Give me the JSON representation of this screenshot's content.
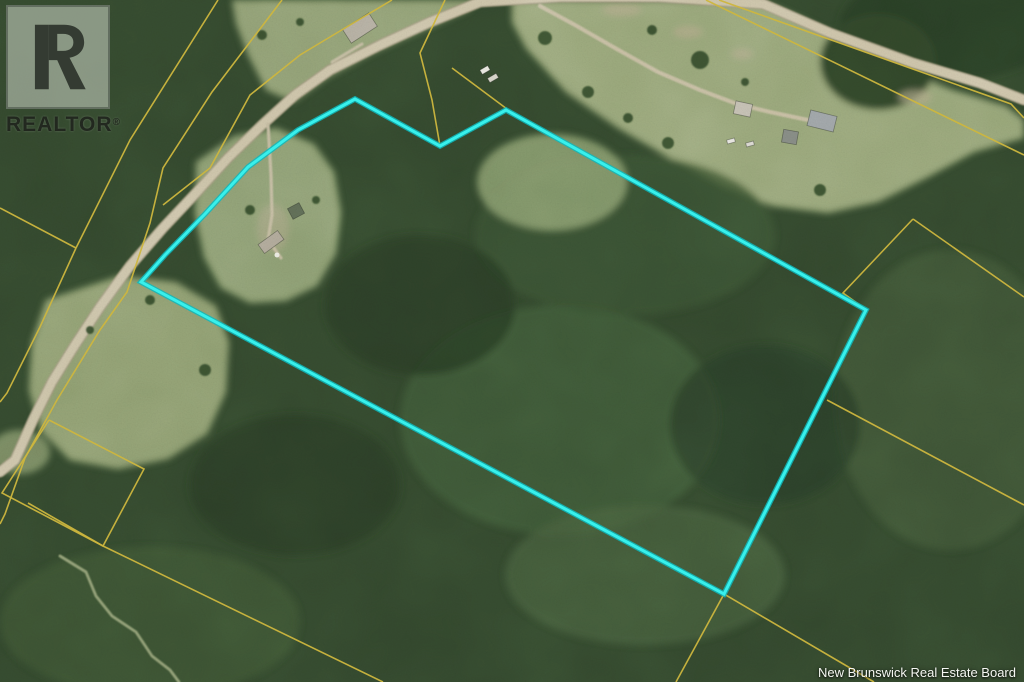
{
  "watermark": {
    "logo_text": "REALTOR",
    "registered_mark": "®"
  },
  "attribution": {
    "text": "New Brunswick Real Estate Board"
  },
  "map": {
    "canvas": {
      "width": 1024,
      "height": 682
    },
    "colors": {
      "boundary_cyan": "#38f0ec",
      "boundary_cyan_glow": "#0fb8bc",
      "parcel_yellow": "#cdb63e",
      "road_fill": "#d2c9ae",
      "road_edge": "#a89f84",
      "forest_base": "#34492e",
      "pasture": "#9aa87a"
    },
    "property_boundary": {
      "points": [
        [
          141,
          282
        ],
        [
          165,
          255
        ],
        [
          205,
          214
        ],
        [
          248,
          167
        ],
        [
          298,
          130
        ],
        [
          355,
          99
        ],
        [
          440,
          146
        ],
        [
          506,
          110
        ],
        [
          866,
          310
        ],
        [
          724,
          594
        ]
      ]
    },
    "parcel_lines": [
      {
        "name": "parcel-line-nw-diagonal-1",
        "points": [
          [
            218,
            0
          ],
          [
            130,
            140
          ],
          [
            76,
            248
          ]
        ]
      },
      {
        "name": "parcel-line-west-branch",
        "points": [
          [
            76,
            248
          ],
          [
            0,
            208
          ]
        ]
      },
      {
        "name": "parcel-line-road-west",
        "points": [
          [
            76,
            248
          ],
          [
            40,
            327
          ],
          [
            7,
            393
          ],
          [
            0,
            402
          ]
        ]
      },
      {
        "name": "parcel-line-nw-diagonal-2",
        "points": [
          [
            282,
            0
          ],
          [
            212,
            92
          ],
          [
            163,
            168
          ],
          [
            150,
            223
          ],
          [
            127,
            292
          ],
          [
            100,
            330
          ],
          [
            57,
            400
          ],
          [
            25,
            458
          ],
          [
            5,
            514
          ],
          [
            0,
            524
          ]
        ]
      },
      {
        "name": "parcel-line-road-east",
        "points": [
          [
            392,
            0
          ],
          [
            350,
            25
          ],
          [
            300,
            55
          ],
          [
            250,
            95
          ],
          [
            210,
            168
          ],
          [
            163,
            205
          ]
        ]
      },
      {
        "name": "parcel-line-lot-cross-road",
        "points": [
          [
            445,
            0
          ],
          [
            420,
            53
          ],
          [
            432,
            100
          ],
          [
            440,
            146
          ]
        ]
      },
      {
        "name": "parcel-line-lot-to-peak",
        "points": [
          [
            452,
            68
          ],
          [
            507,
            109
          ]
        ]
      },
      {
        "name": "parcel-line-field-parcel",
        "points": [
          [
            49,
            420
          ],
          [
            144,
            469
          ],
          [
            103,
            546
          ],
          [
            2,
            493
          ],
          [
            49,
            420
          ]
        ]
      },
      {
        "name": "parcel-line-long-south-diagonal",
        "points": [
          [
            28,
            503
          ],
          [
            103,
            546
          ],
          [
            383,
            682
          ]
        ]
      },
      {
        "name": "parcel-line-ne-road-north",
        "points": [
          [
            719,
            0
          ],
          [
            1011,
            104
          ],
          [
            1024,
            118
          ]
        ]
      },
      {
        "name": "parcel-line-ne-road-south",
        "points": [
          [
            706,
            0
          ],
          [
            1024,
            155
          ]
        ]
      },
      {
        "name": "parcel-line-ne-chevron-west",
        "points": [
          [
            913,
            219
          ],
          [
            843,
            293
          ],
          [
            864,
            308
          ]
        ]
      },
      {
        "name": "parcel-line-ne-chevron-east",
        "points": [
          [
            913,
            219
          ],
          [
            1024,
            297
          ]
        ]
      },
      {
        "name": "parcel-line-se-from-boundary",
        "points": [
          [
            827,
            400
          ],
          [
            1024,
            505
          ]
        ]
      },
      {
        "name": "parcel-line-south-corner-east",
        "points": [
          [
            724,
            594
          ],
          [
            874,
            682
          ]
        ]
      },
      {
        "name": "parcel-line-south-corner-south",
        "points": [
          [
            724,
            594
          ],
          [
            676,
            682
          ]
        ]
      }
    ],
    "roads": [
      {
        "name": "main-road",
        "width": 8.5,
        "color": "#cfc6ab",
        "casing": "#a39a7f",
        "points": [
          [
            1024,
            100
          ],
          [
            980,
            83
          ],
          [
            913,
            63
          ],
          [
            830,
            33
          ],
          [
            763,
            4
          ],
          [
            660,
            -3
          ],
          [
            560,
            -3
          ],
          [
            480,
            2
          ],
          [
            430,
            22
          ],
          [
            380,
            45
          ],
          [
            330,
            70
          ],
          [
            295,
            95
          ],
          [
            262,
            125
          ],
          [
            228,
            158
          ],
          [
            196,
            193
          ],
          [
            163,
            228
          ],
          [
            130,
            266
          ],
          [
            100,
            307
          ],
          [
            75,
            345
          ],
          [
            52,
            382
          ],
          [
            33,
            420
          ],
          [
            15,
            460
          ],
          [
            0,
            472
          ]
        ]
      },
      {
        "name": "driveway-northeast",
        "width": 4,
        "color": "#c9c0a4",
        "casing": null,
        "points": [
          [
            540,
            6
          ],
          [
            575,
            25
          ],
          [
            615,
            48
          ],
          [
            658,
            72
          ],
          [
            700,
            90
          ],
          [
            737,
            104
          ],
          [
            770,
            112
          ],
          [
            808,
            120
          ]
        ]
      },
      {
        "name": "driveway-property",
        "width": 3.2,
        "color": "#c6bda2",
        "casing": null,
        "points": [
          [
            268,
            124
          ],
          [
            271,
            175
          ],
          [
            272,
            215
          ],
          [
            268,
            240
          ],
          [
            281,
            258
          ]
        ]
      },
      {
        "name": "driveway-house-topleft",
        "width": 3,
        "color": "#c6bda2",
        "casing": null,
        "points": [
          [
            332,
            62
          ],
          [
            352,
            50
          ],
          [
            362,
            44
          ]
        ]
      },
      {
        "name": "trail-southwest",
        "width": 2.8,
        "color": "#93a077",
        "casing": null,
        "points": [
          [
            60,
            556
          ],
          [
            86,
            572
          ],
          [
            96,
            596
          ],
          [
            112,
            616
          ],
          [
            136,
            632
          ],
          [
            152,
            656
          ],
          [
            170,
            670
          ],
          [
            179,
            682
          ]
        ]
      }
    ],
    "buildings": [
      {
        "name": "house-top-left",
        "cx": 360,
        "cy": 28,
        "w": 31,
        "h": 16,
        "rot": -33,
        "fill": "#b6b0a2"
      },
      {
        "name": "vehicle-top-1",
        "cx": 485,
        "cy": 70,
        "w": 9,
        "h": 5,
        "rot": -30,
        "fill": "#ecebe3"
      },
      {
        "name": "vehicle-top-2",
        "cx": 493,
        "cy": 78,
        "w": 10,
        "h": 5,
        "rot": -30,
        "fill": "#d9d6cb"
      },
      {
        "name": "house-north",
        "cx": 743,
        "cy": 109,
        "w": 17,
        "h": 13,
        "rot": 12,
        "fill": "#c6c1b4"
      },
      {
        "name": "barn-north",
        "cx": 822,
        "cy": 121,
        "w": 27,
        "h": 16,
        "rot": 14,
        "fill": "#9fa5a8"
      },
      {
        "name": "shed-north",
        "cx": 790,
        "cy": 137,
        "w": 15,
        "h": 13,
        "rot": 10,
        "fill": "#868b84"
      },
      {
        "name": "car-north-1",
        "cx": 731,
        "cy": 141,
        "w": 8,
        "h": 4,
        "rot": -15,
        "fill": "#e9e8e2"
      },
      {
        "name": "car-north-2",
        "cx": 750,
        "cy": 144,
        "w": 8,
        "h": 4,
        "rot": -15,
        "fill": "#dedcd4"
      },
      {
        "name": "house-in-parcel",
        "cx": 271,
        "cy": 242,
        "w": 24,
        "h": 11,
        "rot": -36,
        "fill": "#b2ab9b"
      },
      {
        "name": "shed-in-parcel",
        "cx": 296,
        "cy": 211,
        "w": 13,
        "h": 12,
        "rot": -28,
        "fill": "#5e6b55"
      }
    ],
    "markers": [
      {
        "name": "white-dot-in-parcel",
        "x": 277,
        "y": 255,
        "r": 2.5,
        "fill": "#efeee6"
      }
    ],
    "terrain": {
      "pastures": [
        {
          "name": "pasture-northeast",
          "fill": "#9aa87a",
          "points": [
            [
              512,
              0
            ],
            [
              760,
              0
            ],
            [
              800,
              18
            ],
            [
              852,
              44
            ],
            [
              902,
              70
            ],
            [
              952,
              90
            ],
            [
              1006,
              106
            ],
            [
              1024,
              120
            ],
            [
              1024,
              138
            ],
            [
              974,
              152
            ],
            [
              928,
              177
            ],
            [
              878,
              202
            ],
            [
              828,
              213
            ],
            [
              773,
              206
            ],
            [
              723,
              186
            ],
            [
              670,
              158
            ],
            [
              618,
              128
            ],
            [
              566,
              92
            ],
            [
              526,
              48
            ],
            [
              512,
              22
            ]
          ]
        },
        {
          "name": "pasture-top-center",
          "fill": "#93a276",
          "points": [
            [
              232,
              0
            ],
            [
              480,
              0
            ],
            [
              468,
              10
            ],
            [
              418,
              32
            ],
            [
              370,
              54
            ],
            [
              328,
              77
            ],
            [
              293,
              102
            ],
            [
              266,
              90
            ],
            [
              248,
              55
            ],
            [
              236,
              24
            ]
          ]
        },
        {
          "name": "clearing-in-parcel",
          "fill": "#90a175",
          "points": [
            [
              196,
              162
            ],
            [
              234,
              136
            ],
            [
              276,
              128
            ],
            [
              314,
              144
            ],
            [
              334,
              172
            ],
            [
              341,
              212
            ],
            [
              336,
              254
            ],
            [
              317,
              286
            ],
            [
              286,
              301
            ],
            [
              250,
              303
            ],
            [
              221,
              288
            ],
            [
              204,
              257
            ],
            [
              195,
              214
            ]
          ]
        },
        {
          "name": "field-west",
          "fill": "#92a173",
          "points": [
            [
              46,
              300
            ],
            [
              120,
              276
            ],
            [
              176,
              282
            ],
            [
              216,
              306
            ],
            [
              229,
              342
            ],
            [
              226,
              392
            ],
            [
              207,
              434
            ],
            [
              168,
              459
            ],
            [
              118,
              469
            ],
            [
              70,
              460
            ],
            [
              41,
              431
            ],
            [
              29,
              390
            ],
            [
              32,
              342
            ]
          ]
        }
      ],
      "forest_patches": [
        {
          "name": "forest-topright-corner",
          "cx": 950,
          "cy": 25,
          "rx": 110,
          "ry": 55,
          "fill": "#2c4128",
          "op": 1
        },
        {
          "name": "forest-ne-mid",
          "cx": 878,
          "cy": 62,
          "rx": 58,
          "ry": 48,
          "fill": "#30462b",
          "op": 1
        },
        {
          "name": "light-forest-right",
          "cx": 950,
          "cy": 400,
          "rx": 115,
          "ry": 150,
          "fill": "#415839",
          "op": 0.8
        },
        {
          "name": "light-forest-mid",
          "cx": 560,
          "cy": 420,
          "rx": 160,
          "ry": 115,
          "fill": "#45603b",
          "op": 0.7
        },
        {
          "name": "light-forest-lowmid",
          "cx": 645,
          "cy": 575,
          "rx": 140,
          "ry": 70,
          "fill": "#4a633e",
          "op": 0.7
        },
        {
          "name": "light-forest-upmid",
          "cx": 625,
          "cy": 235,
          "rx": 150,
          "ry": 80,
          "fill": "#3c5433",
          "op": 0.8
        },
        {
          "name": "dark-forest-1",
          "cx": 420,
          "cy": 305,
          "rx": 95,
          "ry": 70,
          "fill": "#293d26",
          "op": 0.8
        },
        {
          "name": "dark-forest-2",
          "cx": 765,
          "cy": 425,
          "rx": 95,
          "ry": 80,
          "fill": "#2a3e27",
          "op": 0.7
        },
        {
          "name": "dark-forest-3",
          "cx": 295,
          "cy": 485,
          "rx": 105,
          "ry": 70,
          "fill": "#2b3f28",
          "op": 0.8
        },
        {
          "name": "light-forest-bottomleft",
          "cx": 150,
          "cy": 622,
          "rx": 150,
          "ry": 75,
          "fill": "#3d5536",
          "op": 0.8
        },
        {
          "name": "pasture-sw-lobe",
          "cx": 552,
          "cy": 182,
          "rx": 75,
          "ry": 48,
          "fill": "#8da172",
          "op": 0.85
        },
        {
          "name": "grass-left-edge",
          "cx": 20,
          "cy": 452,
          "rx": 30,
          "ry": 22,
          "fill": "#8a9a6e",
          "op": 0.8
        },
        {
          "name": "clearing-dirt",
          "cx": 273,
          "cy": 228,
          "rx": 16,
          "ry": 24,
          "fill": "#b4ab8d",
          "op": 0.5
        }
      ],
      "dirt_patches": [
        {
          "cx": 688,
          "cy": 32,
          "rx": 15,
          "ry": 6
        },
        {
          "cx": 742,
          "cy": 54,
          "rx": 11,
          "ry": 5
        },
        {
          "cx": 915,
          "cy": 97,
          "rx": 17,
          "ry": 7
        },
        {
          "cx": 622,
          "cy": 10,
          "rx": 20,
          "ry": 6
        }
      ],
      "bushes": [
        [
          545,
          38,
          7
        ],
        [
          588,
          92,
          6
        ],
        [
          628,
          118,
          5
        ],
        [
          668,
          143,
          6
        ],
        [
          700,
          60,
          9
        ],
        [
          652,
          30,
          5
        ],
        [
          745,
          82,
          4
        ],
        [
          820,
          190,
          6
        ],
        [
          262,
          35,
          5
        ],
        [
          300,
          22,
          4
        ],
        [
          150,
          300,
          5
        ],
        [
          205,
          370,
          6
        ],
        [
          90,
          330,
          4
        ],
        [
          250,
          210,
          5
        ],
        [
          316,
          200,
          4
        ]
      ]
    }
  }
}
